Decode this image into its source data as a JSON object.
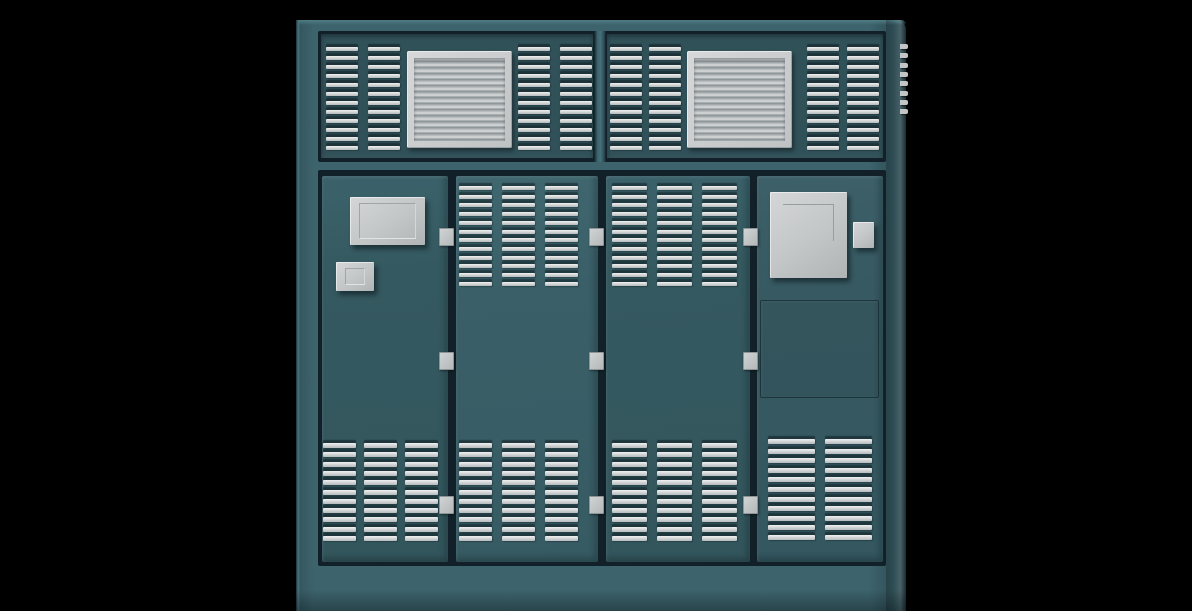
{
  "scene": {
    "description": "3D render of a teal industrial utility cabinet with louvered vents, two top fan grilles, four hinged access doors, two small junction boxes, a breaker box with handle, and a recessed lower panel",
    "background_color": "#000000"
  },
  "palette": {
    "frame": "#3d636c",
    "band": "#315159",
    "door_a": "#355960",
    "door_b": "#3a5f68",
    "door_c": "#375961",
    "groove": "#122129",
    "slat_hi": "#f0f1f1",
    "slat_lo": "#b6babc",
    "metal": "#c3c6c7"
  },
  "cabinet": {
    "door_top": 156,
    "door_height": 386,
    "doors": [
      {
        "name": "door-1",
        "left": 26,
        "width": 126,
        "shade": "a"
      },
      {
        "name": "door-2",
        "left": 160,
        "width": 142,
        "shade": "b"
      },
      {
        "name": "door-3",
        "left": 310,
        "width": 144,
        "shade": "a"
      },
      {
        "name": "door-4",
        "left": 461,
        "width": 126,
        "shade": "c"
      }
    ],
    "louver_groups": [
      {
        "name": "top-vent-left-outer",
        "left": 30,
        "top": 27,
        "cols": 2,
        "col_pitch": 42,
        "rows": 12,
        "row_pitch": 9,
        "slat_w": 32,
        "slat_h": 4
      },
      {
        "name": "top-vent-left-inner",
        "left": 222,
        "top": 27,
        "cols": 2,
        "col_pitch": 42,
        "rows": 12,
        "row_pitch": 9,
        "slat_w": 32,
        "slat_h": 4
      },
      {
        "name": "top-vent-right-outer",
        "left": 314,
        "top": 27,
        "cols": 2,
        "col_pitch": 39,
        "rows": 12,
        "row_pitch": 9,
        "slat_w": 32,
        "slat_h": 4
      },
      {
        "name": "top-vent-right-inner",
        "left": 511,
        "top": 27,
        "cols": 2,
        "col_pitch": 40,
        "rows": 12,
        "row_pitch": 9,
        "slat_w": 32,
        "slat_h": 4
      },
      {
        "name": "door2-upper-vents",
        "left": 163,
        "top": 166,
        "cols": 3,
        "col_pitch": 43,
        "rows": 12,
        "row_pitch": 8.7,
        "slat_w": 33,
        "slat_h": 4
      },
      {
        "name": "door3-upper-vents",
        "left": 316,
        "top": 166,
        "cols": 3,
        "col_pitch": 45,
        "rows": 12,
        "row_pitch": 8.7,
        "slat_w": 35,
        "slat_h": 4
      },
      {
        "name": "door1-lower-vents",
        "left": 27,
        "top": 423,
        "cols": 3,
        "col_pitch": 41,
        "rows": 11,
        "row_pitch": 9.3,
        "slat_w": 33,
        "slat_h": 4.5
      },
      {
        "name": "door2-lower-vents",
        "left": 163,
        "top": 423,
        "cols": 3,
        "col_pitch": 43,
        "rows": 11,
        "row_pitch": 9.3,
        "slat_w": 33,
        "slat_h": 4.5
      },
      {
        "name": "door3-lower-vents",
        "left": 316,
        "top": 423,
        "cols": 3,
        "col_pitch": 45,
        "rows": 11,
        "row_pitch": 9.3,
        "slat_w": 35,
        "slat_h": 4.5
      },
      {
        "name": "door4-lower-vents",
        "left": 472,
        "top": 419,
        "cols": 2,
        "col_pitch": 57,
        "rows": 11,
        "row_pitch": 9.6,
        "slat_w": 47,
        "slat_h": 4.5
      }
    ],
    "grilles": [
      {
        "name": "top-grille-left",
        "left": 111,
        "top": 31,
        "width": 105,
        "height": 97
      },
      {
        "name": "top-grille-right",
        "left": 391,
        "top": 31,
        "width": 105,
        "height": 97
      }
    ],
    "boxes": [
      {
        "name": "door1-junction-box-large",
        "left": 54,
        "top": 177,
        "width": 75,
        "height": 48,
        "inner": "recess"
      },
      {
        "name": "door1-junction-box-small",
        "left": 40,
        "top": 242,
        "width": 38,
        "height": 29,
        "inner": "recess"
      },
      {
        "name": "door4-breaker-box",
        "left": 474,
        "top": 172,
        "width": 77,
        "height": 86,
        "inner": "line"
      },
      {
        "name": "door4-handle-block",
        "left": 557,
        "top": 202,
        "width": 21,
        "height": 26,
        "inner": "none"
      }
    ],
    "hinges": [
      {
        "left": 143,
        "top": 208
      },
      {
        "left": 143,
        "top": 332
      },
      {
        "left": 143,
        "top": 476
      },
      {
        "left": 293,
        "top": 208
      },
      {
        "left": 293,
        "top": 332
      },
      {
        "left": 293,
        "top": 476
      },
      {
        "left": 447,
        "top": 208
      },
      {
        "left": 447,
        "top": 332
      },
      {
        "left": 447,
        "top": 476
      }
    ],
    "recessed_panel": {
      "left": 464,
      "top": 280,
      "width": 117,
      "height": 96
    },
    "serrations": {
      "left": 604,
      "top": 24,
      "count": 8,
      "pitch": 9.3,
      "width": 8,
      "height": 5
    }
  }
}
